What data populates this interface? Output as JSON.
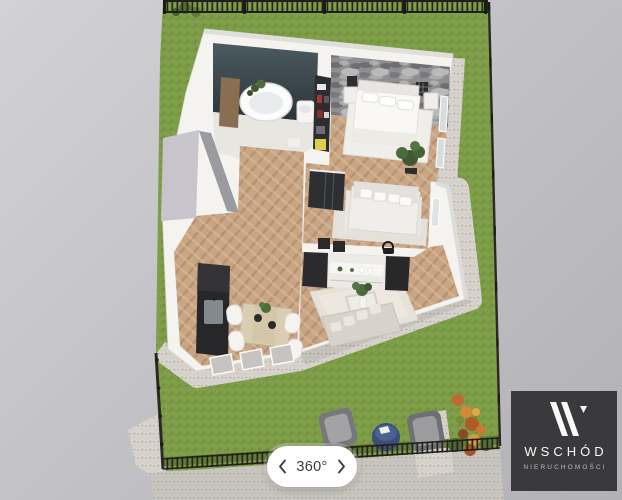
{
  "viewer": {
    "description": "3D isometric floor plan render of a one-bedroom apartment with fenced garden",
    "rooms_visible": [
      "bathroom",
      "bedroom",
      "hallway",
      "second-room-with-sofa",
      "kitchen-dining",
      "living-room",
      "garden-terrace"
    ],
    "palette": {
      "background_gray": "#c3c2c6",
      "grass_green": "#7d9c48",
      "gravel": "#d7d3cc",
      "wall_white": "#f4f3f0",
      "wood_floor": "#c7a585",
      "bathroom_accent_wall": "#39464b",
      "bedroom_accent_wall": "#8f8f91",
      "fence_dark": "#26241f",
      "furniture_dark": "#2b2b2e",
      "terrace_table_navy": "#3a4f76"
    }
  },
  "controls": {
    "rotation": {
      "label": "360°",
      "prev_icon": "chevron-left-icon",
      "next_icon": "chevron-right-icon"
    }
  },
  "brand": {
    "monogram": "W",
    "name": "WSCHÓD",
    "subtitle": "NIERUCHOMOŚCI",
    "background": "#3a393b",
    "text_color": "#fafafa"
  }
}
